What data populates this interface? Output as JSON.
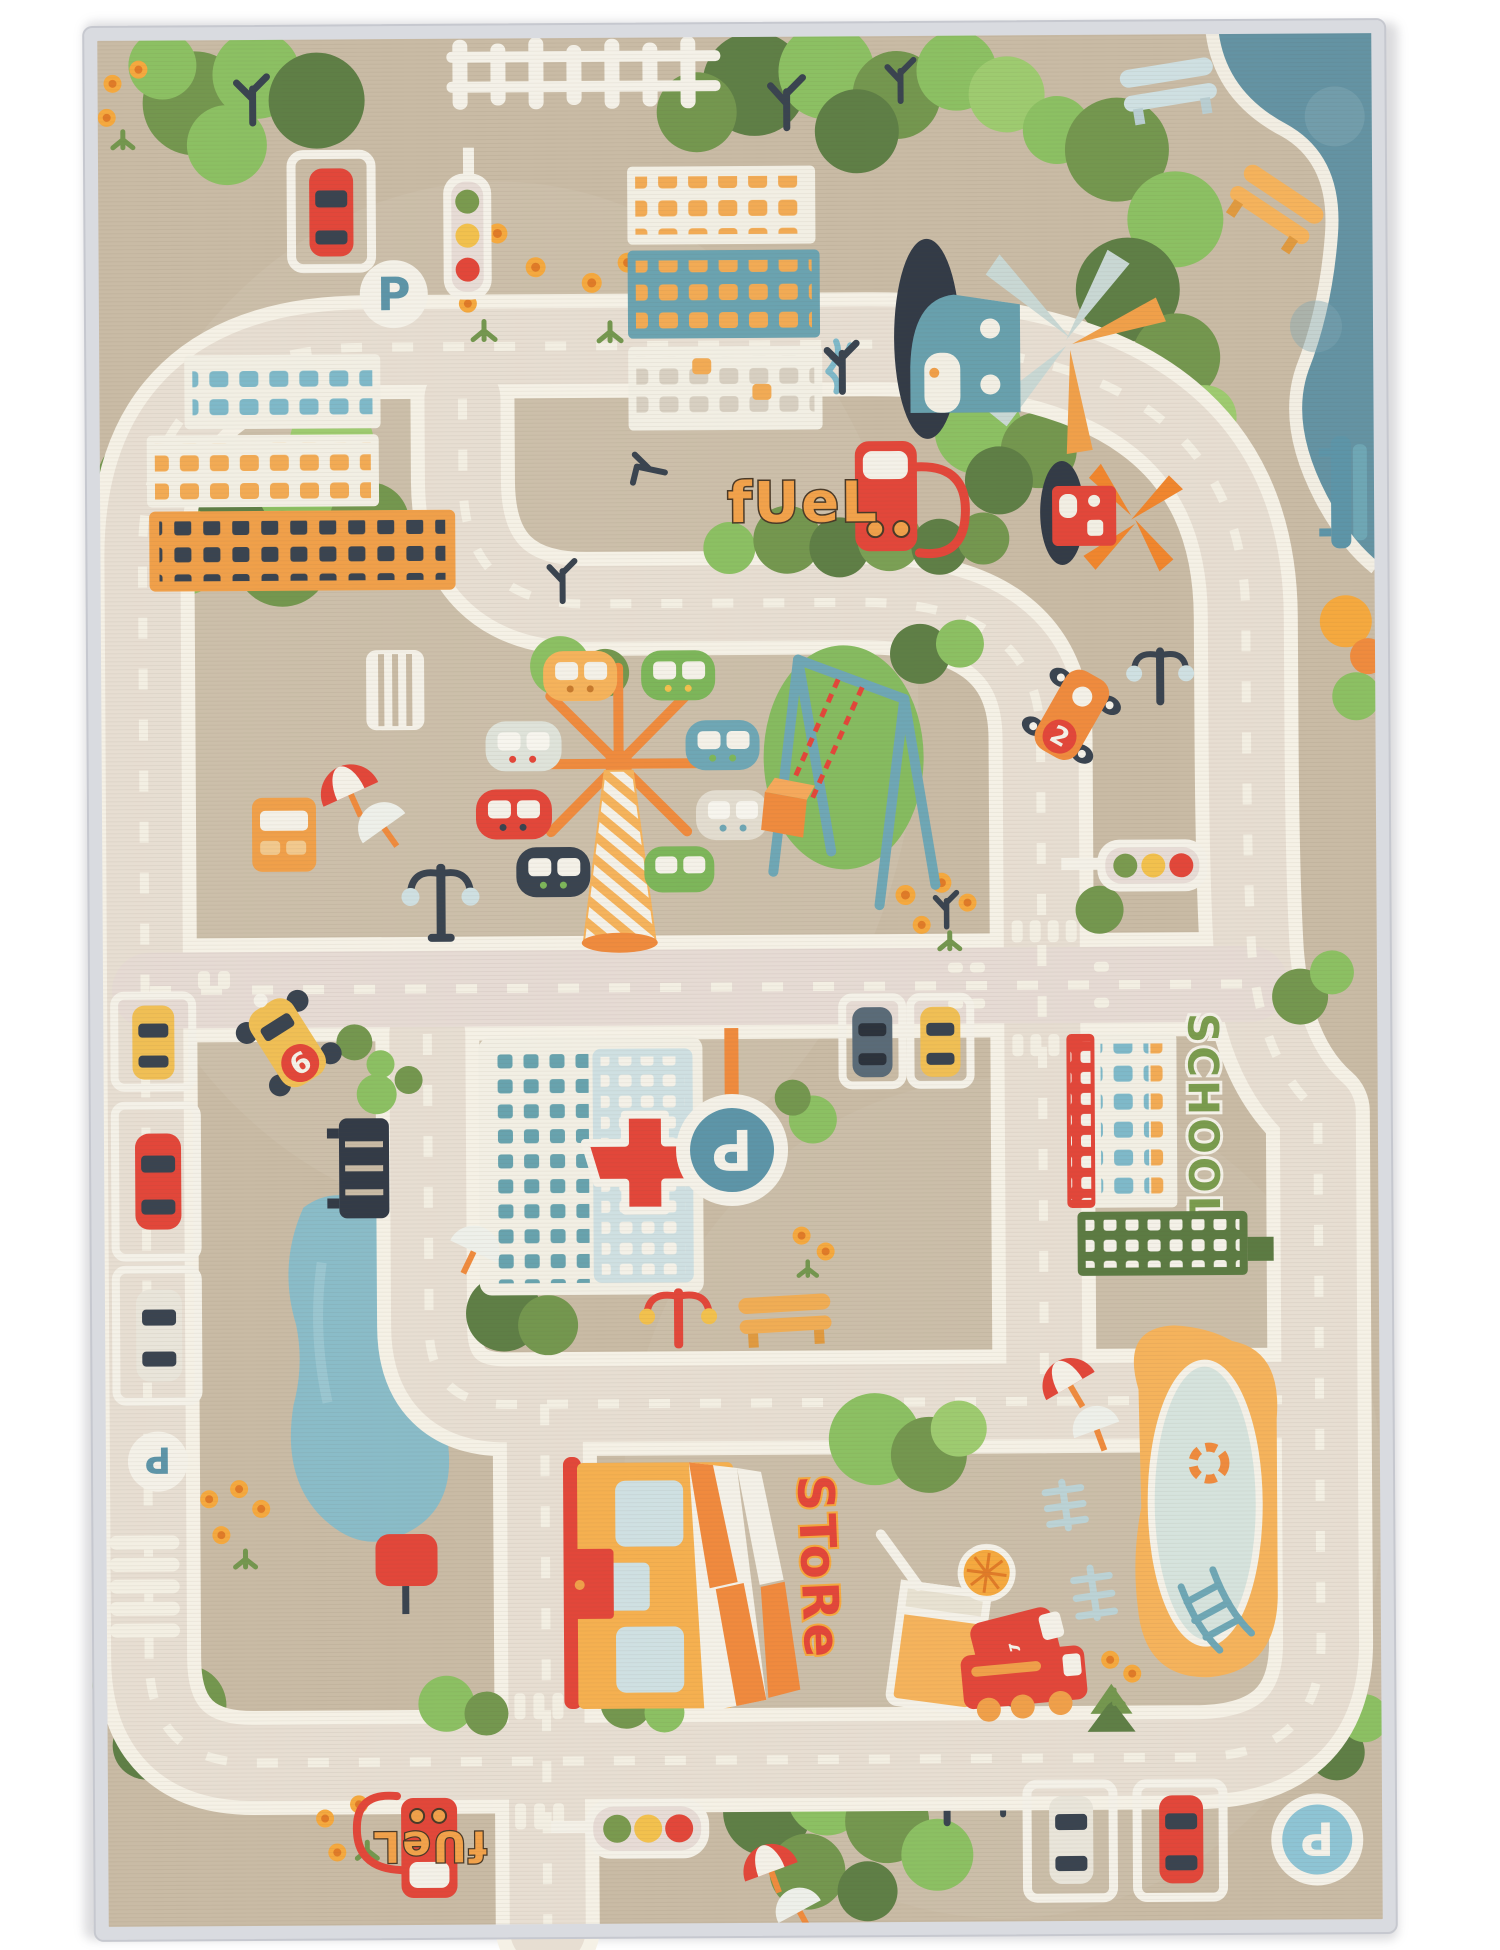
{
  "scene": {
    "type": "product-photo",
    "subject": "children city road play rug, top view",
    "background_color": "#ffffff"
  },
  "rug": {
    "edge_binding_color": "#d9dbe0",
    "field_color": "#c9bba5",
    "road_fill_color": "#e7ded2",
    "road_edge_color": "#f5f1e6"
  },
  "labels": {
    "fuel_sign_top": "fUeL",
    "fuel_sign_bottom": "fUeL",
    "school_sign": "SCHOOL",
    "store_sign": "SToRe",
    "parking_letter": "P",
    "taxi_number": "6",
    "car_number": "2",
    "music_note": "♪"
  },
  "palette": {
    "red": "#e2473a",
    "orange": "#ef8b3e",
    "light_orange": "#f5b35c",
    "window_orange": "#f2ab55",
    "yellow": "#f0bf55",
    "green_dark": "#5f7f46",
    "green_mid": "#74974f",
    "green_light": "#8cc063",
    "steel_blue": "#6fa7b5",
    "sign_blue": "#5d95a8",
    "sign_blue_light": "#8ec4d4",
    "navy": "#3a4450",
    "water_teal": "#6493a3",
    "pond_blue": "#8abcc8",
    "hospital_panel": "#cfe0e2",
    "school_text_green": "#7a9c4e",
    "fuel_text_orange": "#f2a24b"
  },
  "inventory": {
    "traffic_lights": 3,
    "parking_signs": 4,
    "fuel_pumps": 2,
    "windmill_houses": 2,
    "benches": 5,
    "cars_and_trucks": 12
  }
}
